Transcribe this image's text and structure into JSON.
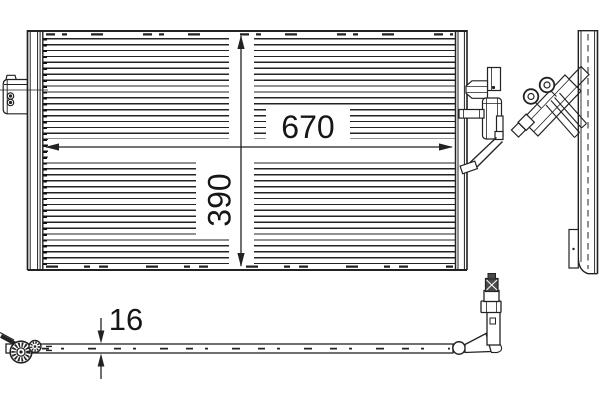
{
  "dimensions": {
    "width_label": "670",
    "height_label": "390",
    "thickness_label": "16"
  },
  "colors": {
    "line": "#222222",
    "background": "#ffffff"
  }
}
